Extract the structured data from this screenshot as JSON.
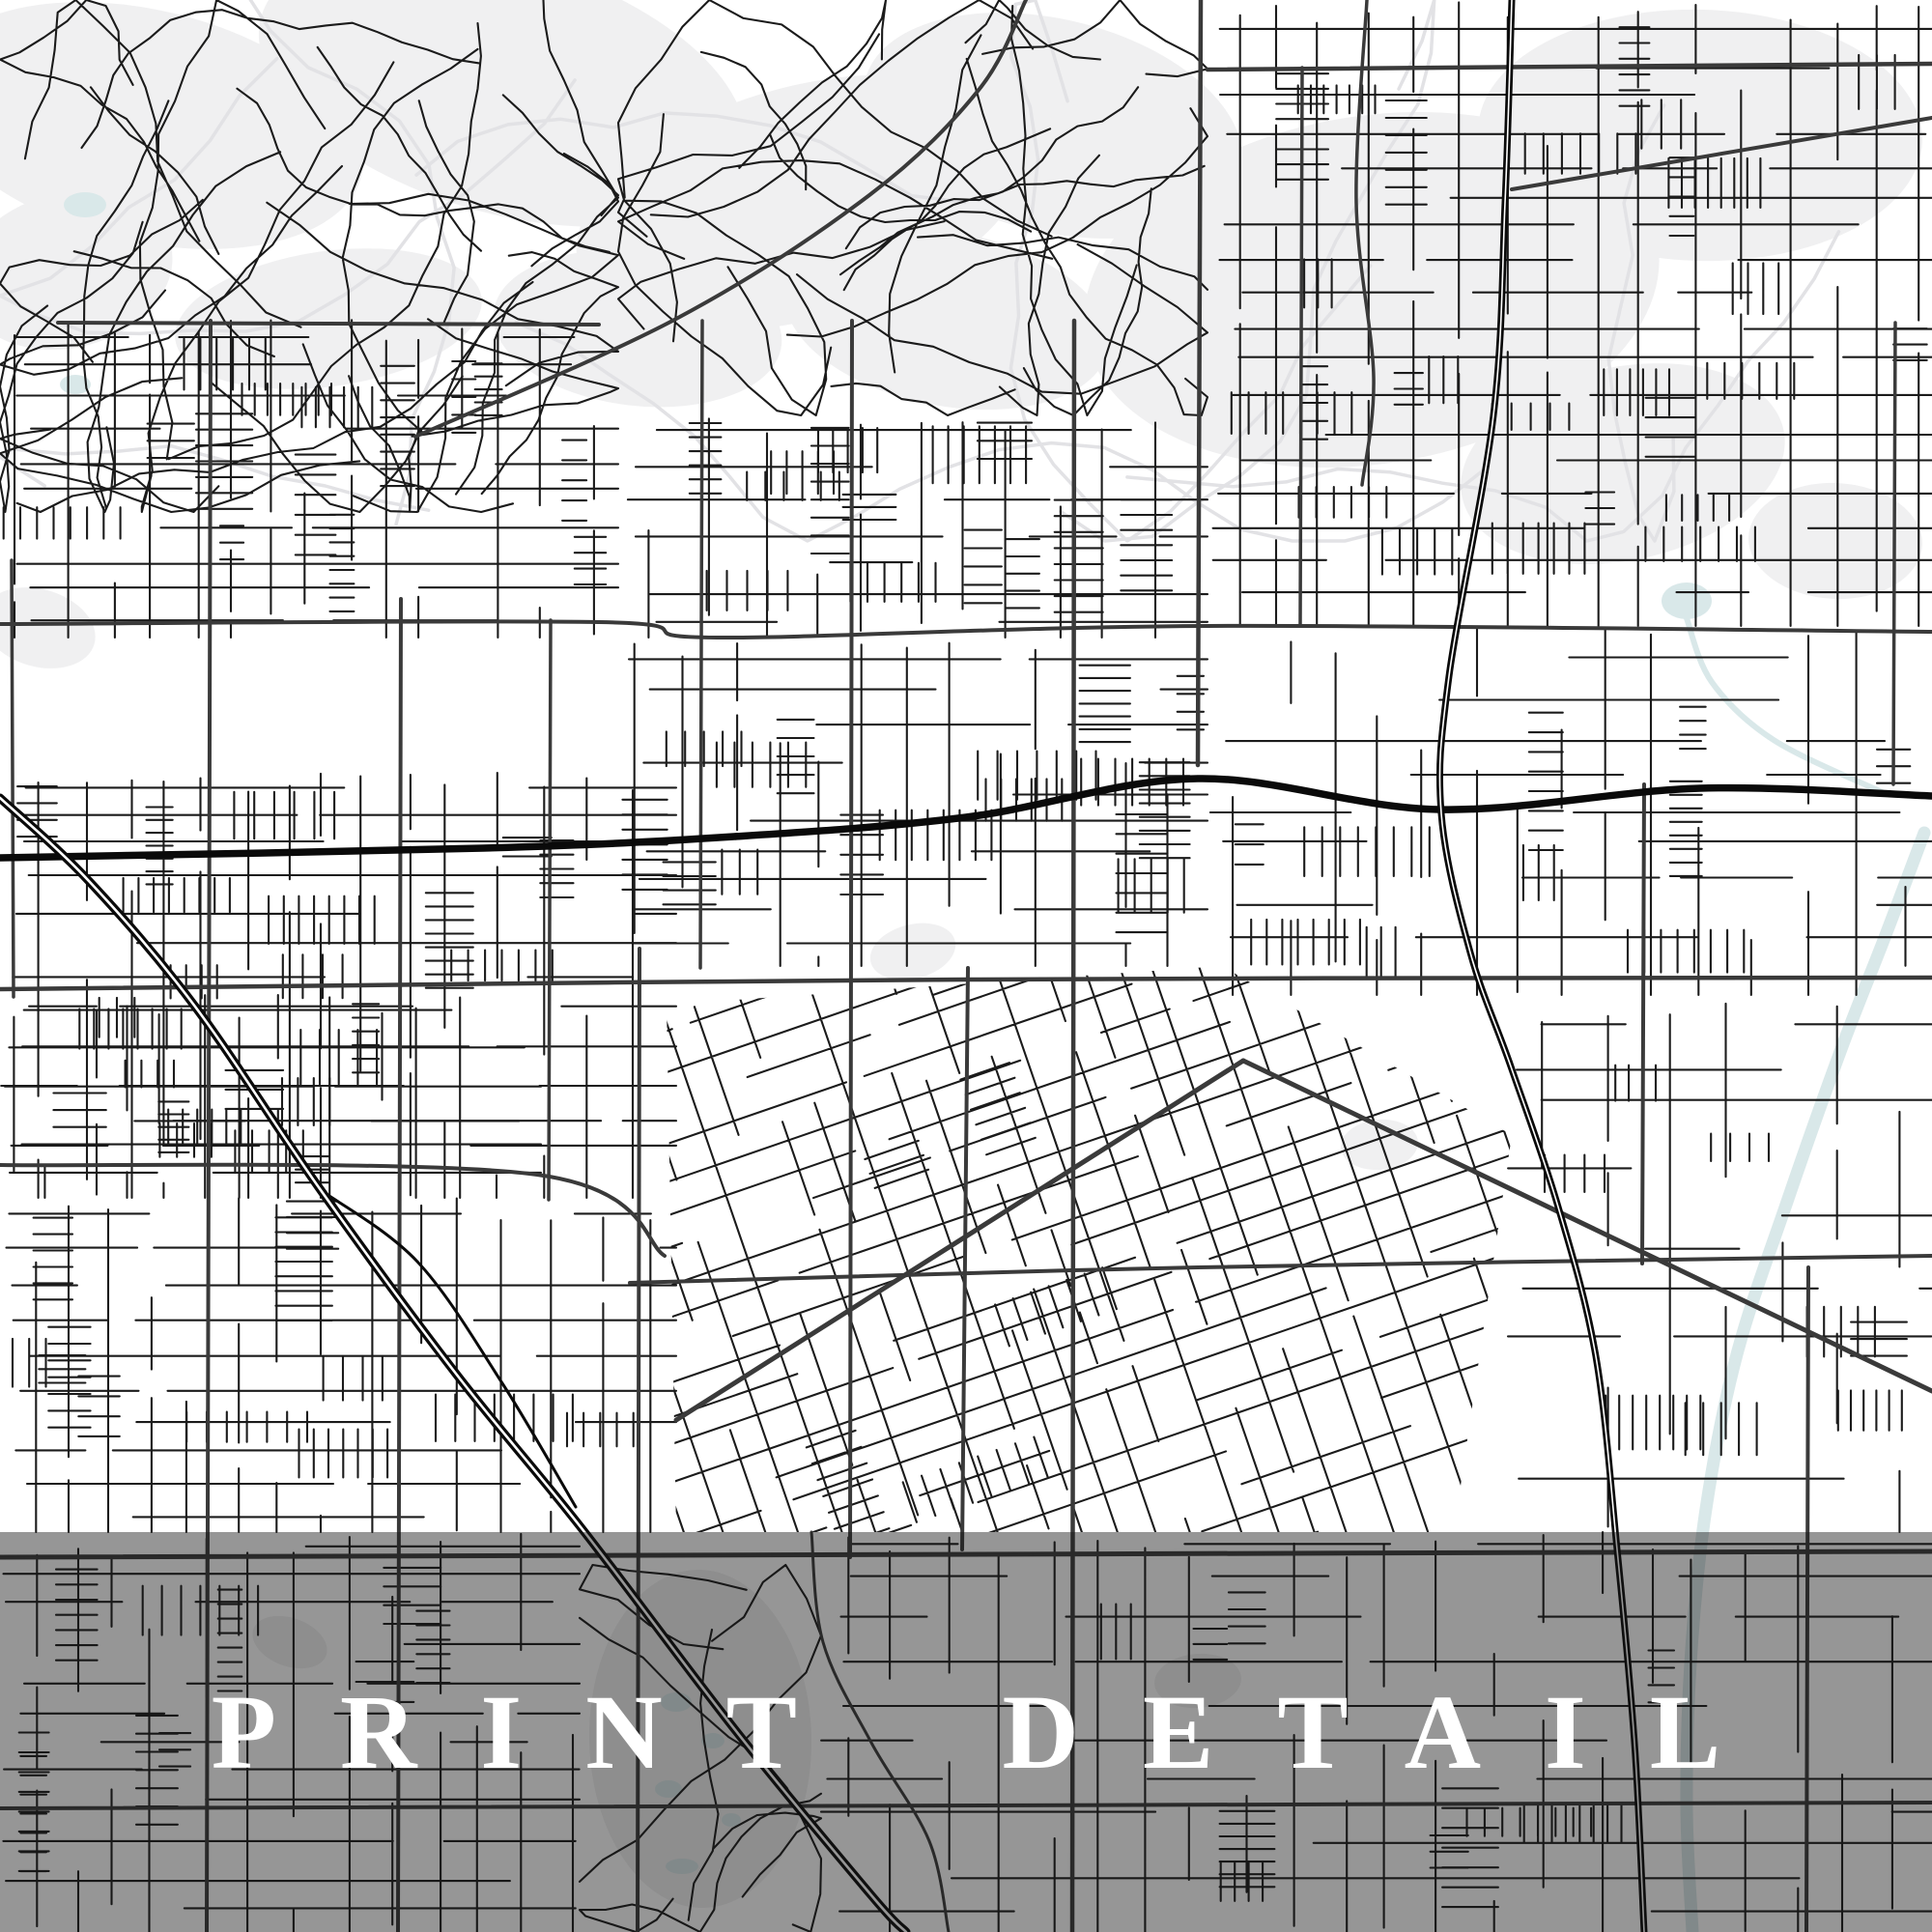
{
  "overlay": {
    "label": "PRINT DETAIL",
    "background": "rgba(22,22,22,0.45)",
    "text_color": "#ffffff"
  },
  "map": {
    "seed": 1371,
    "colors": {
      "bg": "#ffffff",
      "street": "#1b1b1b",
      "collector": "#3a3a3a",
      "major": "#0a0a0a",
      "core": "#ffffff",
      "water": "#d9e8e9",
      "patch": "#f0f0f1",
      "contour": "#e2e2e5"
    },
    "contours": {
      "region": [
        0,
        0,
        2000,
        560
      ],
      "count": 9
    },
    "patches": [
      [
        150,
        130,
        230,
        120
      ],
      [
        520,
        90,
        260,
        130
      ],
      [
        830,
        210,
        240,
        120
      ],
      [
        1090,
        130,
        200,
        110
      ],
      [
        1420,
        300,
        300,
        180
      ],
      [
        1760,
        140,
        230,
        130
      ],
      [
        70,
        280,
        110,
        80
      ],
      [
        340,
        330,
        160,
        70
      ],
      [
        660,
        340,
        150,
        80
      ],
      [
        980,
        330,
        170,
        90
      ],
      [
        1680,
        480,
        170,
        100
      ],
      [
        40,
        650,
        60,
        40
      ],
      [
        945,
        985,
        45,
        28
      ],
      [
        1428,
        1185,
        40,
        26
      ],
      [
        300,
        1700,
        40,
        25
      ],
      [
        1240,
        1740,
        45,
        28
      ],
      [
        725,
        1800,
        115,
        175
      ],
      [
        1900,
        560,
        90,
        60
      ]
    ],
    "ponds": [
      [
        88,
        212,
        22,
        13
      ],
      [
        78,
        398,
        16,
        10
      ],
      [
        1746,
        622,
        26,
        19
      ],
      [
        700,
        1762,
        16,
        10
      ],
      [
        738,
        1802,
        12,
        8
      ],
      [
        692,
        1852,
        14,
        9
      ],
      [
        757,
        1884,
        10,
        7
      ],
      [
        706,
        1932,
        17,
        8
      ]
    ],
    "river": {
      "pts": [
        [
          1992,
          862
        ],
        [
          1952,
          968
        ],
        [
          1906,
          1086
        ],
        [
          1850,
          1244
        ],
        [
          1798,
          1402
        ],
        [
          1766,
          1562
        ],
        [
          1750,
          1722
        ],
        [
          1746,
          1872
        ],
        [
          1752,
          2000
        ]
      ],
      "w": 13
    },
    "canal": {
      "pts": [
        [
          1746,
          640
        ],
        [
          1772,
          706
        ],
        [
          1836,
          766
        ],
        [
          1948,
          820
        ]
      ],
      "w": 6
    },
    "zones": [
      {
        "type": "organic",
        "rect": [
          0,
          0,
          640,
          530
        ],
        "curves": 30
      },
      {
        "type": "organic",
        "rect": [
          640,
          0,
          1250,
          430
        ],
        "curves": 24
      },
      {
        "type": "grid",
        "rect": [
          1250,
          0,
          2000,
          648
        ],
        "cw": 46,
        "ch": 32,
        "density": 0.92,
        "stubs": 26
      },
      {
        "type": "grid",
        "rect": [
          640,
          430,
          1250,
          660
        ],
        "cw": 50,
        "ch": 30,
        "density": 0.85,
        "stubs": 14
      },
      {
        "type": "grid",
        "rect": [
          0,
          330,
          640,
          660
        ],
        "cw": 44,
        "ch": 30,
        "density": 0.85,
        "stubs": 14
      },
      {
        "type": "grid",
        "rect": [
          0,
          800,
          700,
          1240
        ],
        "cw": 42,
        "ch": 32,
        "density": 0.8,
        "stubs": 16
      },
      {
        "type": "grid",
        "rect": [
          640,
          660,
          1250,
          1000
        ],
        "cw": 46,
        "ch": 30,
        "density": 0.8,
        "stubs": 16
      },
      {
        "type": "grid",
        "rect": [
          1250,
          650,
          2000,
          1030
        ],
        "cw": 52,
        "ch": 34,
        "density": 0.65,
        "stubs": 10
      },
      {
        "type": "tilted",
        "poly": [
          [
            690,
            1040
          ],
          [
            1265,
            1000
          ],
          [
            1565,
            1175
          ],
          [
            1505,
            1586
          ],
          [
            700,
            1586
          ]
        ],
        "angle": -19,
        "cw": 40,
        "ch": 30,
        "density": 0.88,
        "stubs": 12
      },
      {
        "type": "grid",
        "rect": [
          0,
          1030,
          560,
          1240
        ],
        "cw": 42,
        "ch": 30,
        "density": 0.8,
        "stubs": 8
      },
      {
        "type": "grid",
        "rect": [
          0,
          1240,
          700,
          1586
        ],
        "cw": 42,
        "ch": 30,
        "density": 0.82,
        "stubs": 12
      },
      {
        "type": "grid",
        "rect": [
          1560,
          1030,
          2000,
          1586
        ],
        "cw": 54,
        "ch": 38,
        "density": 0.6,
        "stubs": 8
      },
      {
        "type": "grid",
        "rect": [
          0,
          1586,
          600,
          2000
        ],
        "cw": 46,
        "ch": 34,
        "density": 0.75,
        "stubs": 10
      },
      {
        "type": "grid",
        "rect": [
          850,
          1586,
          2000,
          2000
        ],
        "cw": 50,
        "ch": 36,
        "density": 0.7,
        "stubs": 10
      },
      {
        "type": "organic",
        "rect": [
          600,
          1620,
          850,
          2000
        ],
        "curves": 6
      }
    ],
    "collectors": [
      {
        "pts": [
          [
            0,
            646
          ],
          [
            620,
            644
          ],
          [
            742,
            660
          ],
          [
            1250,
            648
          ],
          [
            2000,
            654
          ]
        ],
        "w": 4
      },
      {
        "pts": [
          [
            0,
            1024
          ],
          [
            1000,
            1014
          ],
          [
            2000,
            1012
          ]
        ],
        "w": 4.5
      },
      {
        "pts": [
          [
            0,
            1206
          ],
          [
            556,
            1216
          ],
          [
            688,
            1300
          ]
        ],
        "w": 4
      },
      {
        "pts": [
          [
            652,
            1328
          ],
          [
            1240,
            1312
          ],
          [
            2000,
            1300
          ]
        ],
        "w": 4
      },
      {
        "pts": [
          [
            0,
            1612
          ],
          [
            2000,
            1606
          ]
        ],
        "w": 5
      },
      {
        "pts": [
          [
            0,
            1872
          ],
          [
            2000,
            1866
          ]
        ],
        "w": 4
      },
      {
        "pts": [
          [
            1250,
            72
          ],
          [
            2000,
            66
          ]
        ],
        "w": 4.5
      },
      {
        "pts": [
          [
            60,
            334
          ],
          [
            620,
            336
          ]
        ],
        "w": 4
      },
      {
        "pts": [
          [
            1565,
            196
          ],
          [
            2000,
            122
          ]
        ],
        "w": 4
      },
      {
        "pts": [
          [
            1287,
            1098
          ],
          [
            2000,
            1440
          ]
        ],
        "w": 5
      },
      {
        "pts": [
          [
            700,
            1470
          ],
          [
            1287,
            1098
          ]
        ],
        "w": 5
      },
      {
        "pts": [
          [
            430,
            452
          ],
          [
            700,
            330
          ],
          [
            900,
            202
          ],
          [
            1014,
            92
          ],
          [
            1062,
            0
          ]
        ],
        "w": 4
      },
      {
        "pts": [
          [
            218,
            332
          ],
          [
            216,
            1160
          ],
          [
            214,
            2000
          ]
        ],
        "w": 4
      },
      {
        "pts": [
          [
            415,
            620
          ],
          [
            412,
            2000
          ]
        ],
        "w": 4
      },
      {
        "pts": [
          [
            570,
            642
          ],
          [
            568,
            1242
          ]
        ],
        "w": 3.5
      },
      {
        "pts": [
          [
            662,
            982
          ],
          [
            660,
            2000
          ]
        ],
        "w": 4
      },
      {
        "pts": [
          [
            727,
            332
          ],
          [
            725,
            1002
          ]
        ],
        "w": 3.5
      },
      {
        "pts": [
          [
            882,
            332
          ],
          [
            880,
            1612
          ]
        ],
        "w": 4
      },
      {
        "pts": [
          [
            1112,
            332
          ],
          [
            1110,
            2000
          ]
        ],
        "w": 4.5
      },
      {
        "pts": [
          [
            1243,
            0
          ],
          [
            1240,
            792
          ]
        ],
        "w": 4.5
      },
      {
        "pts": [
          [
            1348,
            70
          ],
          [
            1346,
            646
          ]
        ],
        "w": 3.5
      },
      {
        "pts": [
          [
            1415,
            0
          ],
          [
            1404,
            210
          ],
          [
            1422,
            390
          ],
          [
            1410,
            502
          ]
        ],
        "w": 3.5
      },
      {
        "pts": [
          [
            1702,
            812
          ],
          [
            1700,
            1308
          ]
        ],
        "w": 4
      },
      {
        "pts": [
          [
            1872,
            1312
          ],
          [
            1870,
            2000
          ]
        ],
        "w": 4
      },
      {
        "pts": [
          [
            1962,
            334
          ],
          [
            1960,
            812
          ]
        ],
        "w": 3.5
      },
      {
        "pts": [
          [
            12,
            580
          ],
          [
            14,
            1032
          ]
        ],
        "w": 3.5
      },
      {
        "pts": [
          [
            1002,
            1002
          ],
          [
            996,
            1604
          ]
        ],
        "w": 4
      },
      {
        "pts": [
          [
            840,
            1586
          ],
          [
            852,
            1700
          ],
          [
            902,
            1804
          ],
          [
            962,
            1906
          ],
          [
            982,
            2000
          ]
        ],
        "w": 3
      }
    ],
    "majors": [
      {
        "pts": [
          [
            0,
            888
          ],
          [
            500,
            878
          ],
          [
            760,
            866
          ],
          [
            1000,
            846
          ],
          [
            1240,
            806
          ],
          [
            1490,
            838
          ],
          [
            1760,
            816
          ],
          [
            2000,
            824
          ]
        ],
        "w": 7.5,
        "core": 0
      },
      {
        "pts": [
          [
            1565,
            0
          ],
          [
            1558,
            210
          ],
          [
            1546,
            430
          ],
          [
            1500,
            700
          ],
          [
            1492,
            842
          ],
          [
            1522,
            986
          ],
          [
            1564,
            1104
          ],
          [
            1612,
            1246
          ],
          [
            1652,
            1404
          ],
          [
            1674,
            1604
          ],
          [
            1692,
            1804
          ],
          [
            1702,
            2000
          ]
        ],
        "w": 7,
        "core": 1.6
      },
      {
        "pts": [
          [
            0,
            826
          ],
          [
            92,
            912
          ],
          [
            202,
            1042
          ],
          [
            332,
            1232
          ],
          [
            472,
            1422
          ],
          [
            602,
            1582
          ],
          [
            762,
            1792
          ],
          [
            902,
            1962
          ],
          [
            938,
            2000
          ]
        ],
        "w": 9,
        "core": 2.6
      }
    ],
    "ramps": [
      {
        "pts": [
          [
            332,
            1232
          ],
          [
            432,
            1306
          ],
          [
            520,
            1432
          ],
          [
            596,
            1560
          ]
        ],
        "w": 3
      }
    ]
  }
}
